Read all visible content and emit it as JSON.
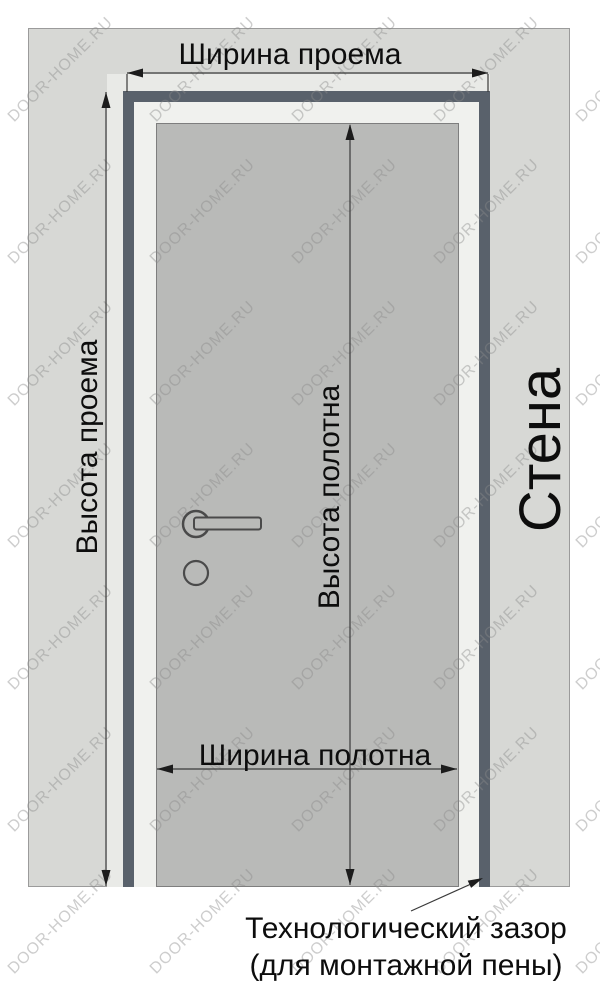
{
  "diagram": {
    "title_top": "Ширина проема",
    "labels": {
      "opening_width": "Ширина проема",
      "opening_height": "Высота проема",
      "leaf_height": "Высота полотна",
      "leaf_width": "Ширина полотна",
      "wall": "Стена",
      "gap_annotation_line1": "Технологический зазор",
      "gap_annotation_line2": "(для монтажной пены)"
    }
  },
  "watermark": {
    "text": "DOOR-HOME.RU"
  },
  "colors": {
    "background": "#ffffff",
    "wall": "#d7d8d5",
    "wall_border": "#9b9b9b",
    "opening_gap": "#e9eae7",
    "frame": "#59616b",
    "frame_inner": "#f0f1ee",
    "door_leaf": "#b9bab8",
    "leaf_border": "#7e7e7e",
    "dimension_line": "#3a3a3a",
    "arrowhead": "#1c1c1c",
    "text": "#0d0d0d",
    "watermark": "#8a8a8a"
  }
}
